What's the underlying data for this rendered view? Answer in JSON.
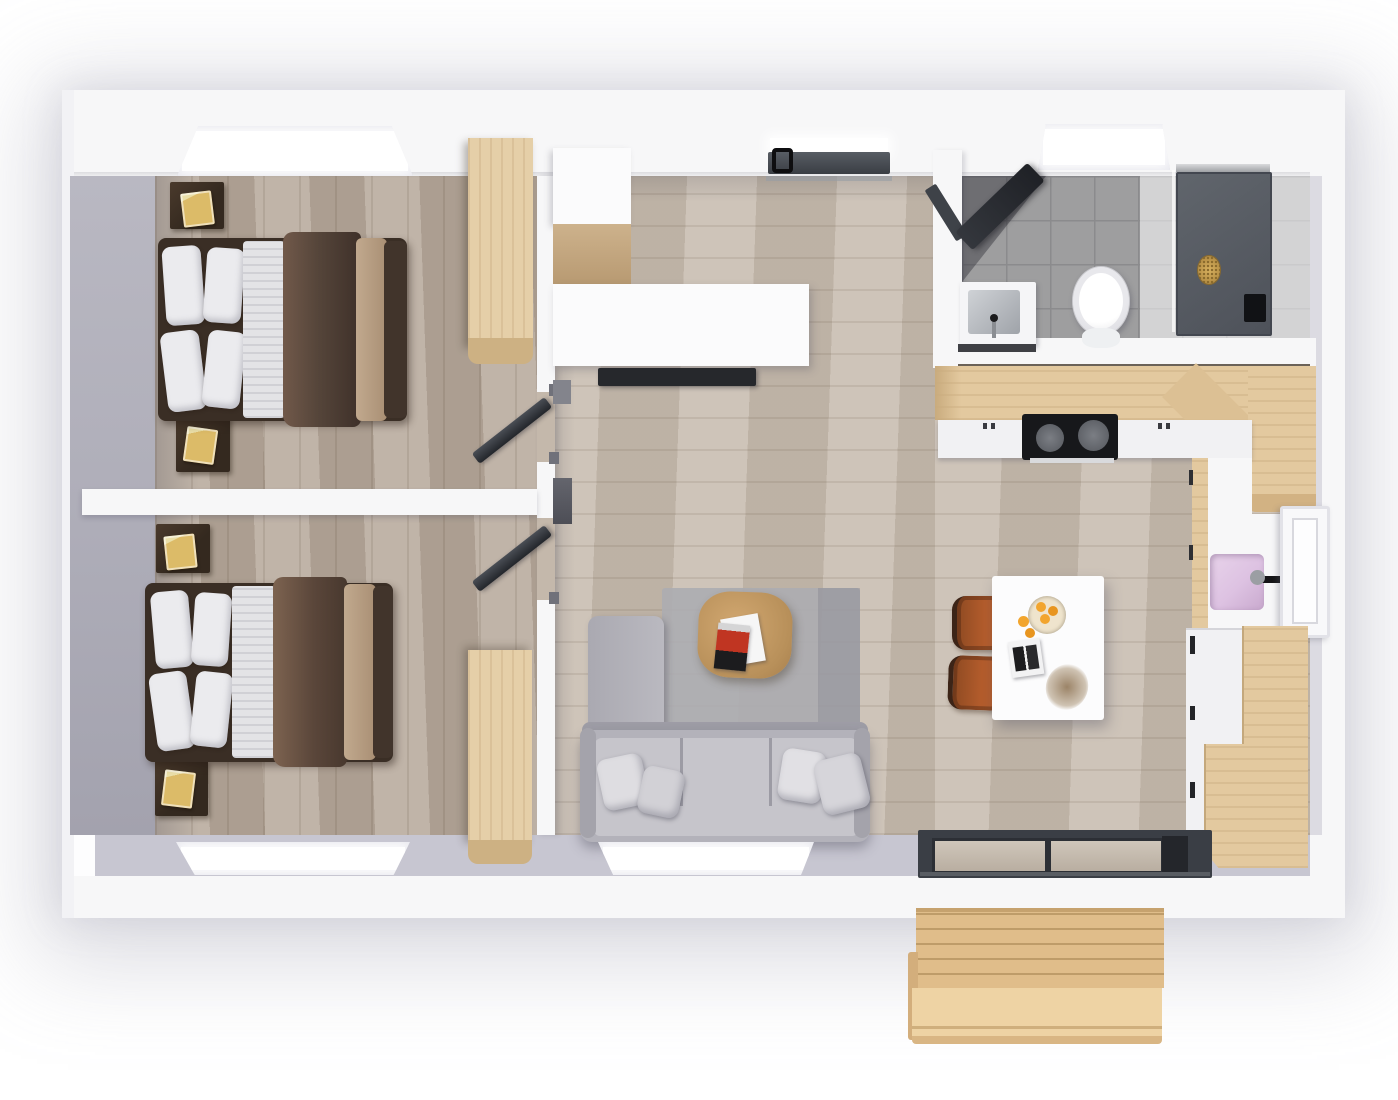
{
  "scene": {
    "type": "3d-floor-plan-top-view-render",
    "rooms": [
      {
        "name": "bedroom-1",
        "furniture": [
          "double-bed",
          "nightstand-with-book",
          "nightstand-with-book",
          "wardrobe",
          "window"
        ]
      },
      {
        "name": "bedroom-2",
        "furniture": [
          "double-bed",
          "nightstand-with-book",
          "nightstand-with-book",
          "wardrobe",
          "window",
          "door"
        ]
      },
      {
        "name": "living-hallway",
        "furniture": [
          "entry-door",
          "tall-cabinet",
          "sideboard",
          "tv",
          "l-shaped-sofa",
          "throw-pillows",
          "rug",
          "coffee-table",
          "magazines",
          "window"
        ]
      },
      {
        "name": "bathroom",
        "furniture": [
          "skylight",
          "vanity-sink",
          "toilet",
          "shower-tray",
          "glass-screen",
          "door"
        ]
      },
      {
        "name": "kitchen",
        "furniture": [
          "l-shaped-counter",
          "cooktop",
          "pink-sink",
          "window",
          "oven-column",
          "tall-wood-cabinets",
          "island-table",
          "two-bar-chairs",
          "fruit-bowl",
          "magazine",
          "dry-plant",
          "sliding-glass-door"
        ]
      },
      {
        "name": "outdoor-deck",
        "furniture": [
          "wood-platform",
          "step"
        ]
      }
    ]
  },
  "palette": {
    "wall": "#f7f7f8",
    "wall-face-left": "#b0afba",
    "wall-face-bottom": "#c7c6d1",
    "floor-bed": "#b5a799",
    "floor-living": "#c5b9ac",
    "tile": "#9e9e9f",
    "tile-line": "#8b8b8d",
    "tile-light": "#e0e0e2",
    "wood-cab": "#e5cfa8",
    "wood-cab-dark": "#cdb183",
    "wood-counter": "#e3c99f",
    "wood-counter-dark": "#d2b283",
    "deck": "#e0bd8a",
    "deck-step": "#eed3a4",
    "bed-frame": "#3a2e25",
    "blanket-a": "#71594a",
    "blanket-b": "#3e3029",
    "throw": "#c1a98e",
    "pillow": "#ebebee",
    "sheet": "#e3e3e6",
    "nightstand": "#34291f",
    "book": "#dcbb68",
    "sofa": "#b3b2ba",
    "sofa-light": "#c6c5cb",
    "sofa-dark": "#9e9da6",
    "rug": "#adacb1",
    "table-wood": "#c79e66",
    "white-furn": "#fbfbfc",
    "tv": "#26282c",
    "door": "#40444b",
    "door-dark": "#23262b",
    "chair": "#b35c2c",
    "orange": "#f2a52e",
    "sink-pink": "#ddc2e2",
    "cooktop": "#17181b",
    "burner": "#72757b",
    "brass": "#c9a250",
    "appliance": "#f1f1f3",
    "glass": "#b9aea1",
    "chrome": "#c9cbcf"
  }
}
